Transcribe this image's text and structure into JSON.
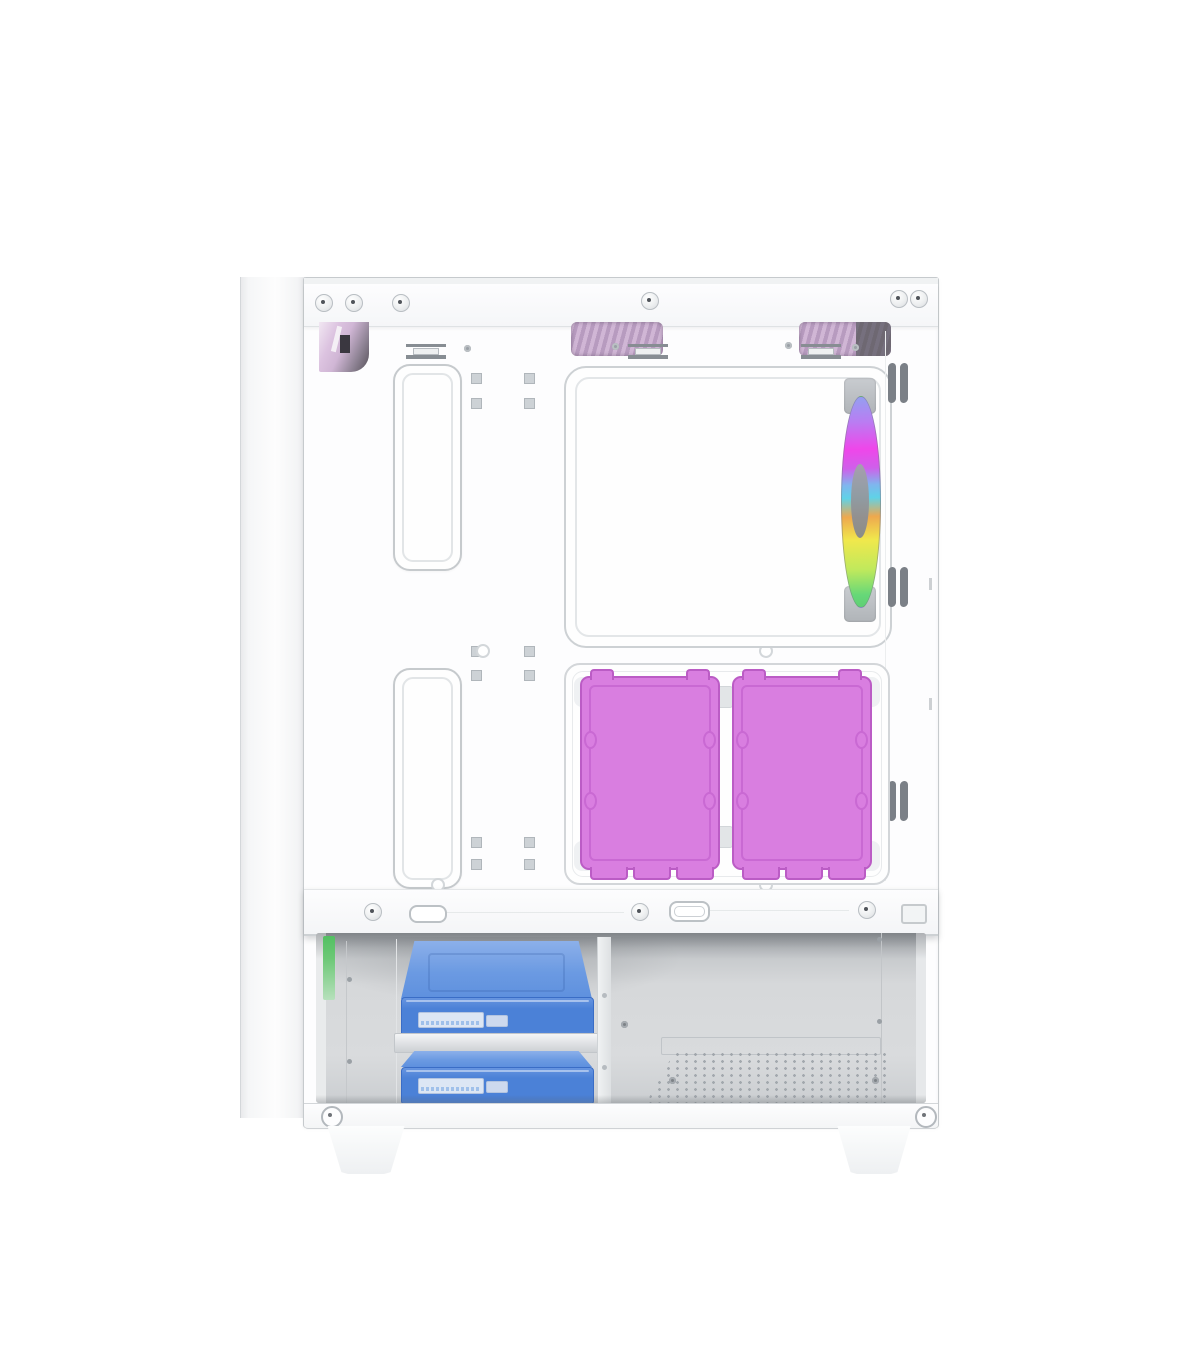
{
  "meta": {
    "subject": "White ATX mid-tower PC case with side panel removed, interior side view on white background"
  },
  "scene": {
    "description": "White mid-tower PC case interior: top ventilation cutouts with pink mesh, large CPU cooler cutout in the motherboard tray, one rainbow RGB exhaust fan at the rear, two magenta 2.5-inch SSDs mounted side by side on the tray, a white power-supply shroud, and two blue 3.5-inch hard drives stacked in the bottom drive cage next to a perforated PSU vent; two white feet at the bottom"
  },
  "components": {
    "rgb_fan_count": 1,
    "ssd_count": 2,
    "hdd_count": 2,
    "cable_grommet_count": 2,
    "foot_count": 2
  },
  "colors": {
    "background": "#ffffff",
    "case_line": "#c6cacd",
    "case_line_soft": "#e2e5e7",
    "screw_ring": "#b9bec3",
    "screw_dot": "#50545a",
    "vent_pink_light": "#d0b6d5",
    "vent_pink_dark": "#b79bbf",
    "vent_gray_dark": "#6e6872",
    "grommet_line": "#c6cacd",
    "fan_frame": "#b0b4b8",
    "fan_hub": "#83868c",
    "fan_rainbow_top": "#93a0f1",
    "fan_rainbow_magenta": "#ef46ea",
    "fan_rainbow_cyan": "#5fd2e8",
    "fan_rainbow_yellow": "#f0e84c",
    "fan_rainbow_green": "#66d878",
    "ssd_pink": "#d97ee0",
    "ssd_pink_line": "#bb5cc5",
    "ssd_pink_inner": "#c969d3",
    "hdd_blue_top": "#6b9ae2",
    "hdd_blue": "#4b81d7",
    "hdd_blue_dark": "#3a6dc6",
    "sata_silver": "#dce6f4",
    "sata_pins": "#9fc0ea",
    "pcb_green": "#6cc876",
    "compartment_gray": "#d6d8da",
    "compartment_shadow": "#9fa3a7",
    "perforation_gray": "#9aa0a6"
  }
}
